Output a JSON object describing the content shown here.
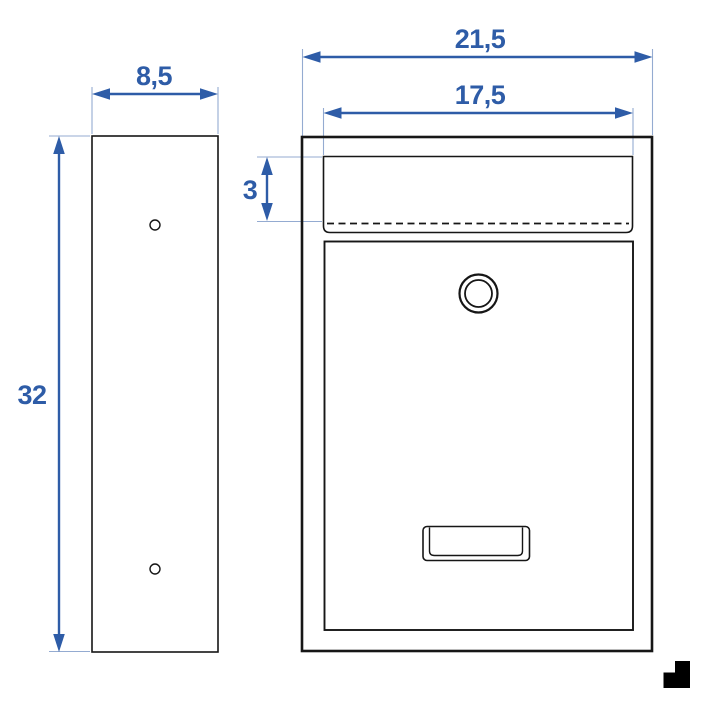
{
  "dimensions": {
    "side_depth": "8,5",
    "side_height": "32",
    "front_width": "21,5",
    "slot_width": "17,5",
    "slot_height": "3"
  },
  "icons": {
    "logo": "corner-step-logo-icon"
  },
  "colors": {
    "dimension": "#2e5ca7",
    "extension": "#94abd1",
    "line": "#161616",
    "background": "#ffffff",
    "logo": "#000000"
  }
}
